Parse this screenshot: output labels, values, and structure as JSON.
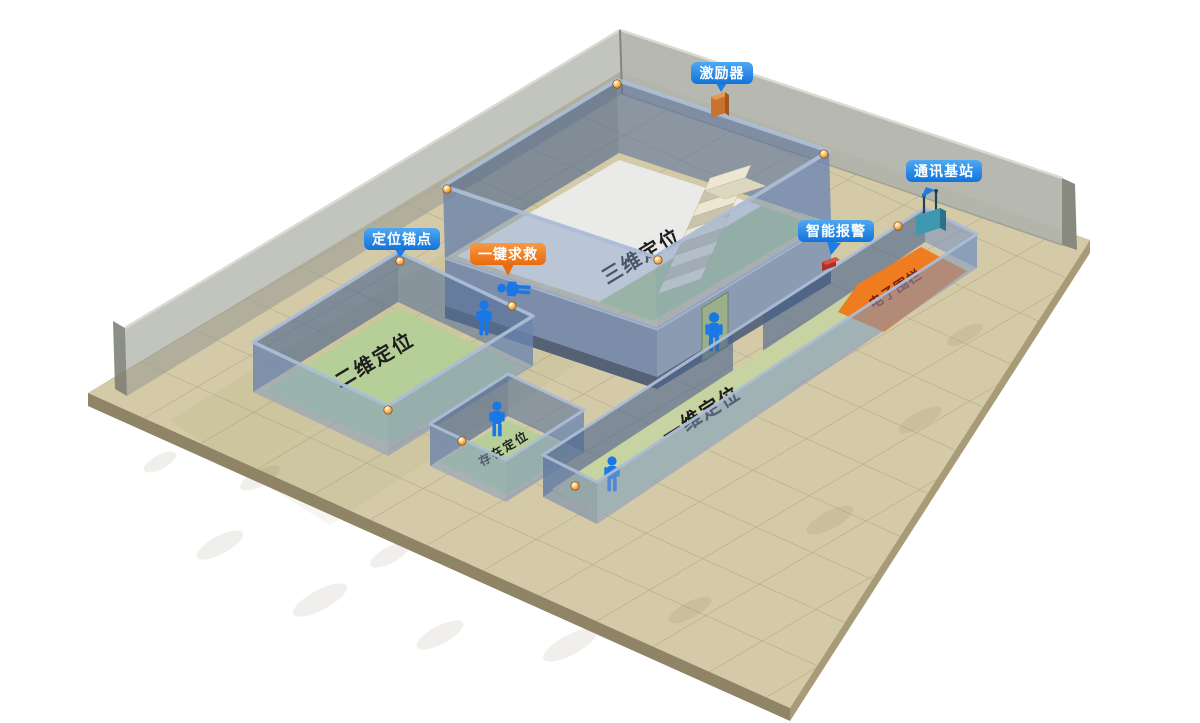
{
  "badges": {
    "exciter": {
      "label": "激励器"
    },
    "comm_station": {
      "label": "通讯基站"
    },
    "smart_alarm": {
      "label": "智能报警"
    },
    "anchor": {
      "label": "定位锚点"
    },
    "sos": {
      "label": "一键求救"
    }
  },
  "areas": {
    "positioning_3d": {
      "label": "三维定位"
    },
    "positioning_2d": {
      "label": "二维定位"
    },
    "presence": {
      "label": "存在定位"
    },
    "positioning_1d": {
      "label": "一维定位"
    },
    "fence": {
      "label": "电子围栏"
    }
  },
  "icons": {
    "exciter": "exciter-device-icon",
    "comm_station": "antenna-base-station-icon",
    "smart_alarm": "alarm-device-icon",
    "anchor": "anchor-ball-icon",
    "sos": "fallen-person-icon",
    "person": "person-icon"
  },
  "colors": {
    "badge_blue": "#2b8fe8",
    "badge_orange": "#ee7c1f",
    "fence_orange": "#ef7c1e",
    "floor_tan": "#d4caa7",
    "room_floor_green": "#b6ce98",
    "deck_green": "#adc890",
    "corridor_floor_green": "#c7d3a1",
    "wall_blue": "#7b8da8",
    "perimeter_wall_gray": "#b2b4aa",
    "person_blue": "#1a78e6",
    "anchor_orange": "#f09020",
    "white_slab": "#eaeae8"
  }
}
